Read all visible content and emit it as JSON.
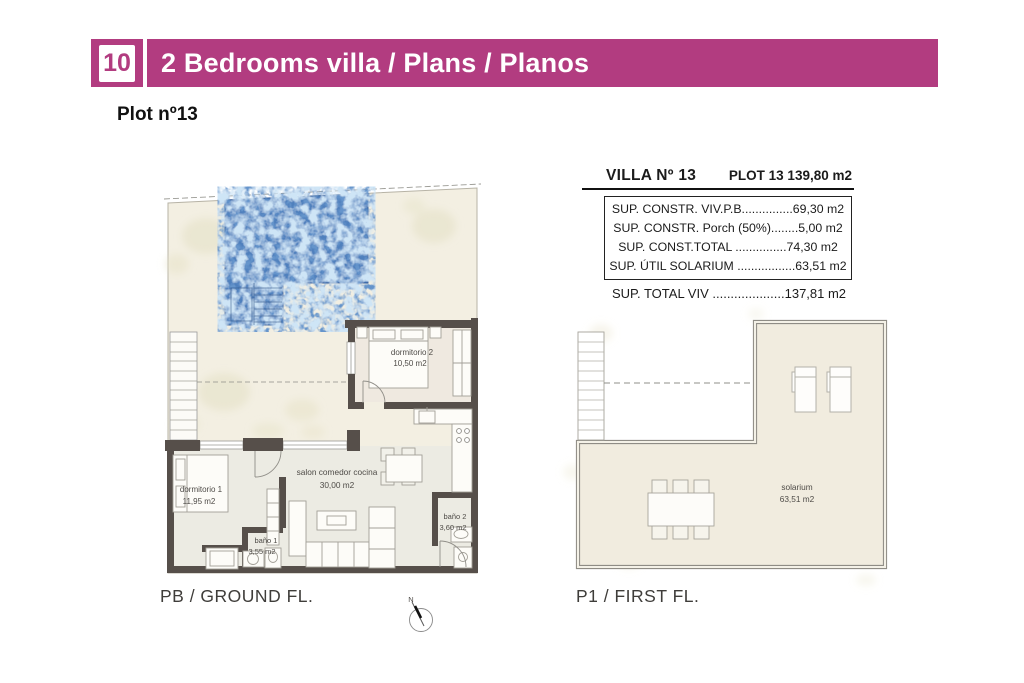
{
  "header": {
    "number": "10",
    "title": "2 Bedrooms villa / Plans / Planos",
    "accent_color": "#b23c80"
  },
  "plot_title": "Plot nº13",
  "info_table": {
    "villa_label": "VILLA Nº 13",
    "plot_label": "PLOT 13 139,80 m2",
    "rows": [
      "SUP. CONSTR. VIV.P.B...............69,30 m2",
      "SUP. CONSTR. Porch (50%)........5,00 m2",
      "SUP. CONST.TOTAL ...............74,30 m2",
      "SUP. ÚTIL SOLARIUM .................63,51 m2"
    ],
    "total": "SUP. TOTAL VIV ....................137,81 m2"
  },
  "ground_floor": {
    "caption": "PB / GROUND FL.",
    "rooms": [
      {
        "name": "dormitorio 1",
        "area": "11,95 m2"
      },
      {
        "name": "dormitorio 2",
        "area": "10,50 m2"
      },
      {
        "name": "salon comedor cocina",
        "area": "30,00 m2"
      },
      {
        "name": "baño 1",
        "area": "3,55 m2"
      },
      {
        "name": "baño 2",
        "area": "3,60 m2"
      }
    ]
  },
  "first_floor": {
    "caption": "P1 / FIRST FL.",
    "rooms": [
      {
        "name": "solarium",
        "area": "63,51 m2"
      }
    ]
  },
  "compass": {
    "label": "N"
  },
  "colors": {
    "accent": "#b23c80",
    "pool_blue": "#4f80bd",
    "wall": "#564f4a",
    "plan_background": "#f3efe2"
  }
}
